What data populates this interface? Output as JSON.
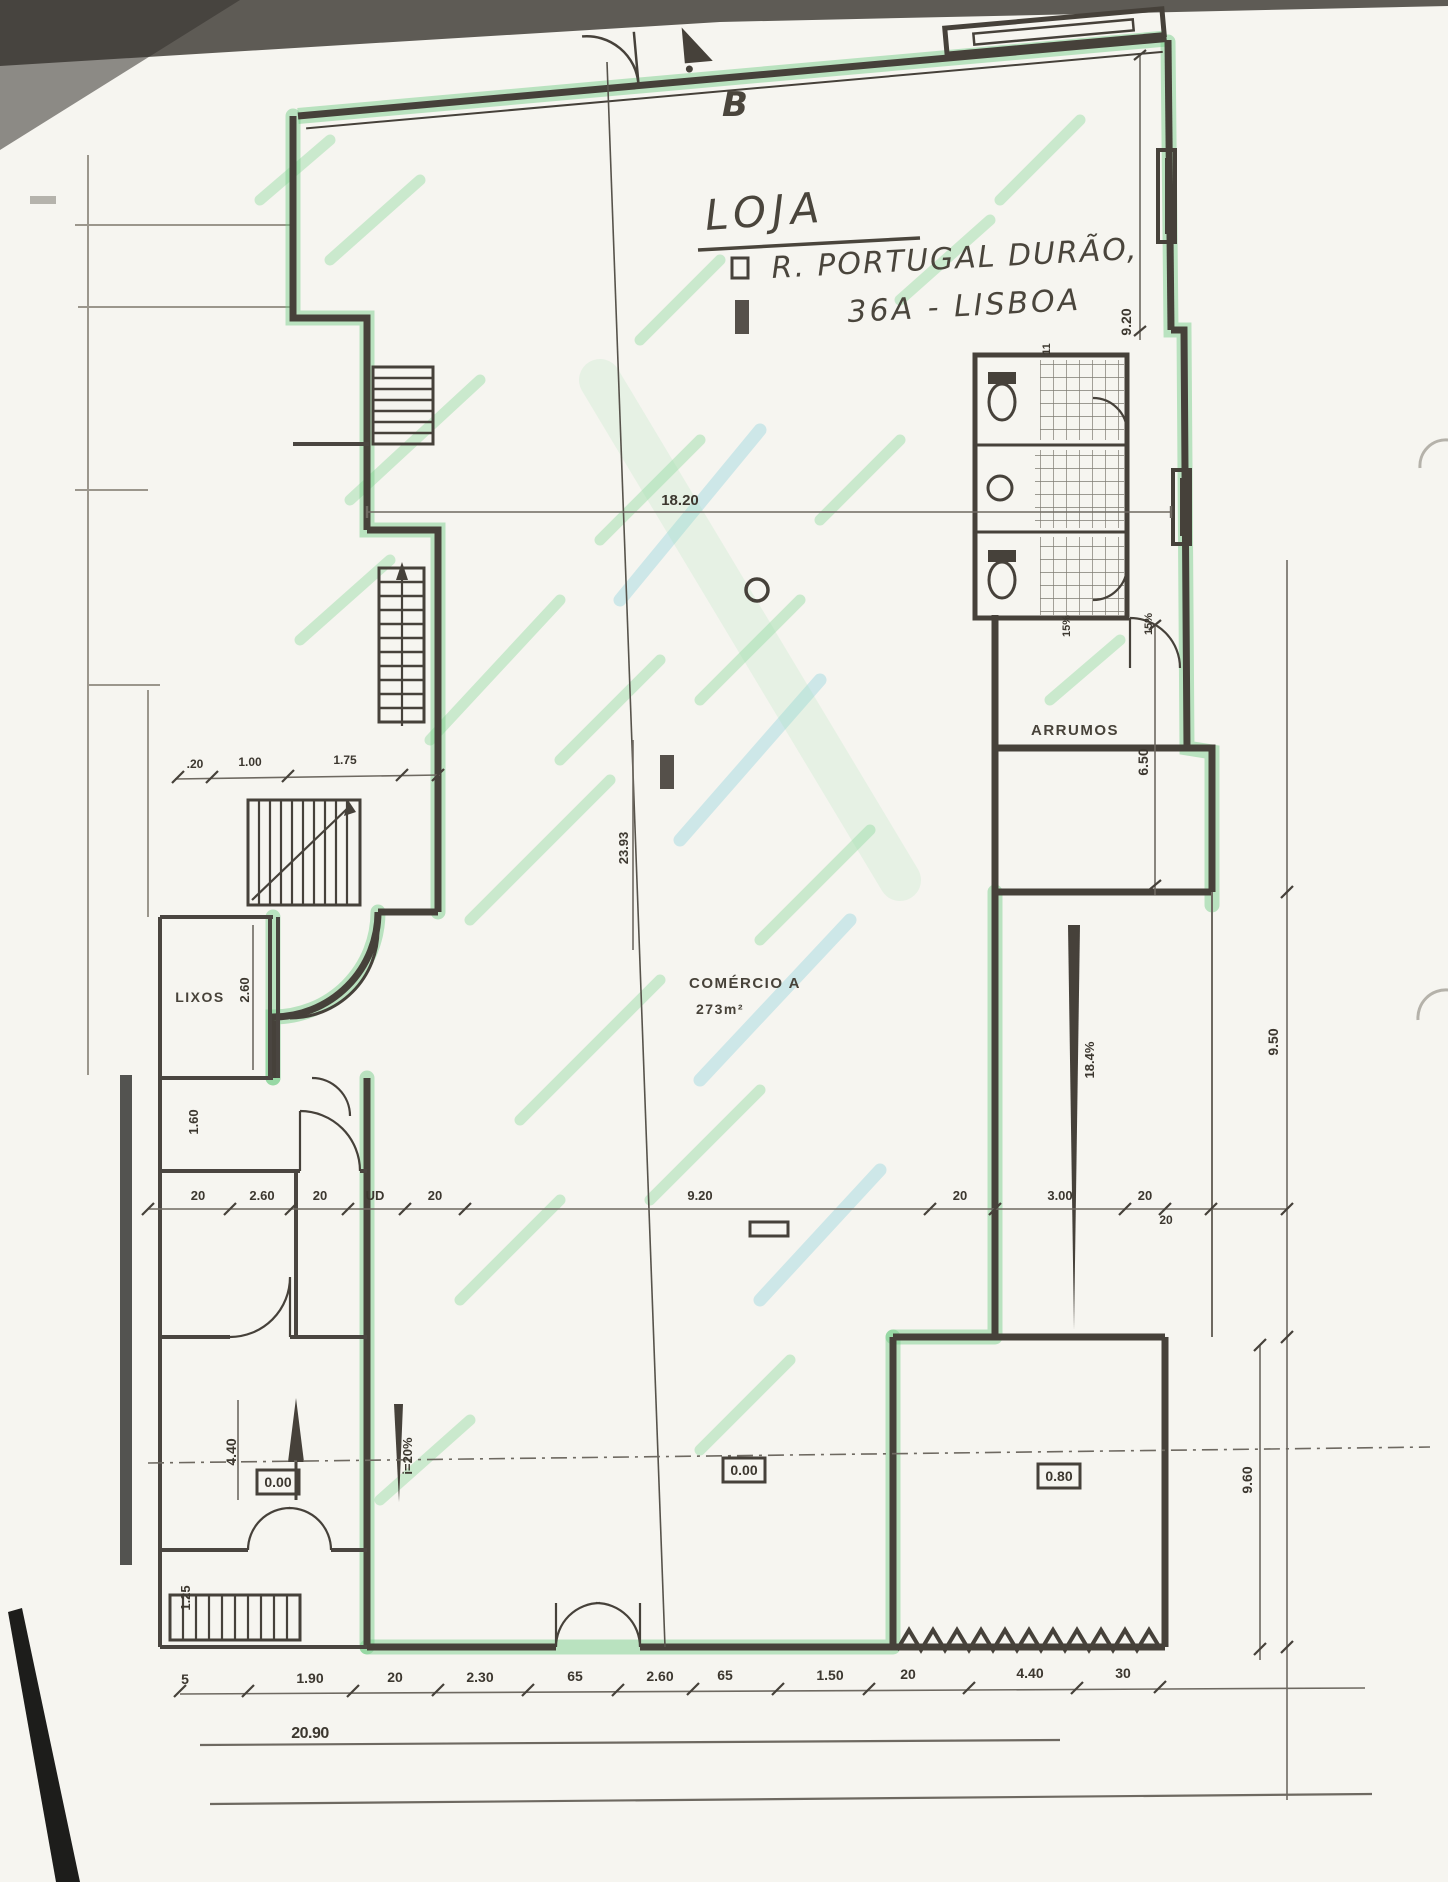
{
  "document": {
    "kind": "scanned architectural floor plan",
    "section_marker": "B"
  },
  "title_block": {
    "line1": "LOJA",
    "line2": "R. PORTUGAL DURÃO,",
    "line3": "36A - LISBOA"
  },
  "rooms": {
    "arrumos": "ARRUMOS",
    "lixos": "LIXOS",
    "comercio_name": "COMÉRCIO A",
    "comercio_area": "273m²"
  },
  "levels": {
    "left": "0.00",
    "middle": "0.00",
    "right": "0.80"
  },
  "slopes": {
    "ramp_right": "18.4%",
    "ramp_left": "i=20%",
    "wc_left": "15%",
    "wc_right": "15%",
    "wc_top": "11"
  },
  "dims": {
    "top_width": "18.20",
    "right_top": "9.20",
    "arrumos_height": "6.50",
    "right_mid": "9.50",
    "right_small": "20",
    "right_bottom": "9.60",
    "axis_length": "23.93",
    "lixos_height": "2.60",
    "lixos_below": "1.60",
    "left_lower": "4.40",
    "left_bottom": "1.25",
    "total_width": "20.90",
    "stair_chain": [
      ".20",
      "1.00",
      "1.75"
    ],
    "middle_chain": [
      "20",
      "2.60",
      "20",
      "UD",
      "20",
      "9.20",
      "20",
      "3.00",
      "20"
    ],
    "bottom_chain": [
      "5",
      "1.90",
      "20",
      "2.30",
      "65",
      "2.60",
      "65",
      "1.50",
      "20",
      "4.40",
      "30"
    ]
  },
  "colors": {
    "highlighter_green": "#7ed394",
    "ink": "#46413a",
    "paper": "#f6f5f0"
  }
}
